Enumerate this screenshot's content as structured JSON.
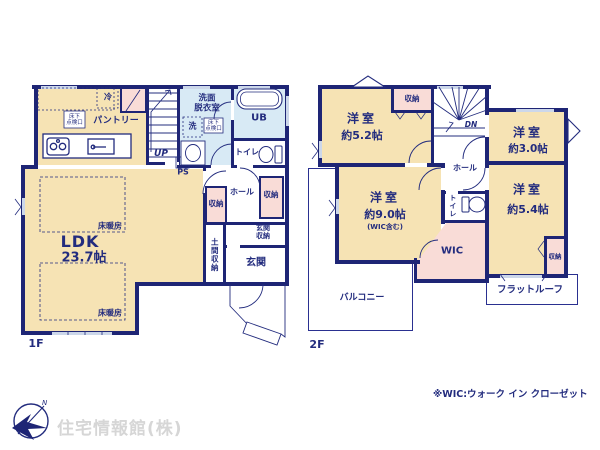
{
  "colors": {
    "wall_navy": "#1e2575",
    "text_navy": "#232c7e",
    "room_yellow": "#f6e3b4",
    "storage_pink": "#f9dcd7",
    "wet_area_blue": "#d8eaf5",
    "window_light": "#ccd7ea",
    "logo_gray": "#d6d6d6"
  },
  "floor1": {
    "floor_label": "1F",
    "ldk": {
      "name": "LDK",
      "size": "23.7帖"
    },
    "floor_heating": [
      "床暖房",
      "床暖房"
    ],
    "fridge": "冷",
    "pantry": "パントリー",
    "underfloor_access_kitchen": {
      "l1": "床下",
      "l2": "点検口"
    },
    "underfloor_access_washroom": {
      "l1": "床下",
      "l2": "点検口"
    },
    "stairs_up": "UP",
    "ps": "PS",
    "washer": "洗",
    "washroom": {
      "l1": "洗面",
      "l2": "脱衣室"
    },
    "bath": "UB",
    "toilet": "トイレ",
    "hall": "ホール",
    "closets": [
      "収納",
      "収納"
    ],
    "entrance_storage": {
      "l1": "玄関",
      "l2": "収納"
    },
    "doma_storage": "土間収納",
    "entrance": "玄関"
  },
  "floor2": {
    "floor_label": "2F",
    "bedroom_52": {
      "name": "洋室",
      "size": "約5.2帖"
    },
    "bedroom_30": {
      "name": "洋室",
      "size": "約3.0帖"
    },
    "bedroom_90": {
      "name": "洋室",
      "size": "約9.0帖",
      "note": "(WIC含む)"
    },
    "bedroom_54": {
      "name": "洋室",
      "size": "約5.4帖"
    },
    "closets": [
      "収納",
      "収納"
    ],
    "stairs_down": "DN",
    "hall": "ホール",
    "toilet": "トイレ",
    "wic": "WIC",
    "balcony": "バルコニー",
    "flat_roof": "フラットルーフ"
  },
  "footer": {
    "wic_note": "※WIC:ウォーク イン クローゼット",
    "company": "住宅情報館(株)",
    "compass_north": "N"
  }
}
